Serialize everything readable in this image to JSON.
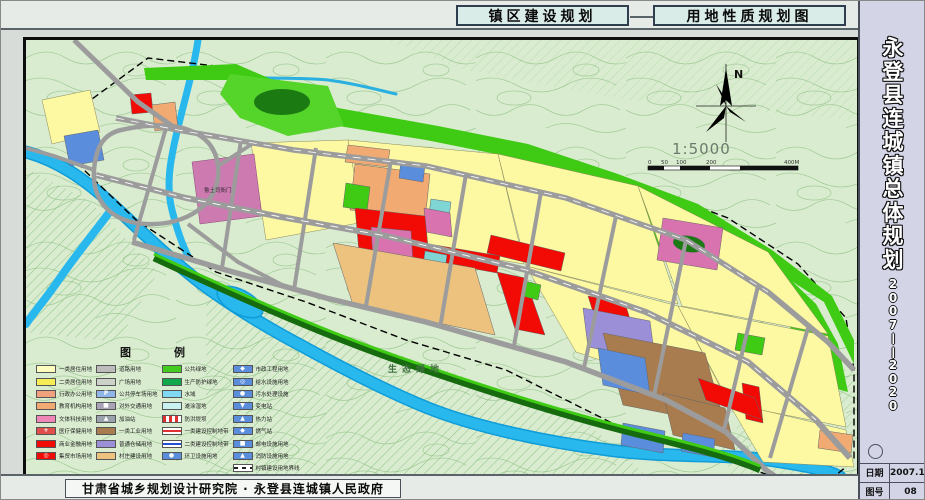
{
  "header": {
    "left_title": "镇区建设规划",
    "right_title": "用地性质规划图"
  },
  "sidebar": {
    "title": "永登县连城镇总体规划",
    "period": "2007——2020",
    "info_rows": [
      {
        "label": "日期",
        "value": "2007.11"
      },
      {
        "label": "图号",
        "value": "08"
      }
    ]
  },
  "footer": {
    "credit": "甘肃省城乡规划设计研究院 · 永登县连城镇人民政府"
  },
  "map": {
    "north_label": "N",
    "scale_text": "1:5000",
    "scale_ticks": [
      "0",
      "50",
      "100",
      "200",
      "400M"
    ],
    "eco_label": "生态绿地",
    "site_label": "鲁土司衙门"
  },
  "palette": {
    "map_bg": "#d9eccf",
    "contour": "#a6cd9c",
    "river": "#28b8ee",
    "green_belt": "#3fca14",
    "dark_green": "#1c7a12",
    "residential": "#fdf8a2",
    "commercial_red": "#f20a05",
    "culture_pink": "#d973b0",
    "education_orange": "#f0aa72",
    "industry_brown": "#a97c50",
    "warehouse_purple": "#9b8fd8",
    "municipal_blue": "#5b8ddd",
    "village_tan": "#ecc27e",
    "road": "#9c9c9c"
  },
  "legend": {
    "title": "图　例",
    "columns": [
      [
        {
          "t": "一类居住用地",
          "sw": "color",
          "c": "#fdfbbe"
        },
        {
          "t": "二类居住用地",
          "sw": "color",
          "c": "#f6ec55"
        },
        {
          "t": "行政办公用地",
          "sw": "color",
          "c": "#f2a17d"
        },
        {
          "t": "教育机构用地",
          "sw": "color",
          "c": "#f0aa72"
        },
        {
          "t": "文体科技用地",
          "sw": "color",
          "c": "#ee86b8"
        },
        {
          "t": "医疗保健用地",
          "sw": "color",
          "c": "#e14f4d",
          "s": "+",
          "scolor": "#ffffff"
        },
        {
          "t": "商业金融用地",
          "sw": "color",
          "c": "#f20a05"
        },
        {
          "t": "集贸市场用地",
          "sw": "color",
          "c": "#f20a05",
          "s": "◎",
          "scolor": "#ffffff"
        }
      ],
      [
        {
          "t": "道路用地",
          "sw": "color",
          "c": "#bcbcbc"
        },
        {
          "t": "广场用地",
          "sw": "color",
          "c": "#ccd2c8"
        },
        {
          "t": "公共停车场用地",
          "sw": "color",
          "c": "#8fb6e9",
          "s": "P",
          "scolor": "#ffffff"
        },
        {
          "t": "对外交通用地",
          "sw": "color",
          "c": "#a8a3b6",
          "s": "■",
          "scolor": "#ffffff"
        },
        {
          "t": "加油站",
          "sw": "color",
          "c": "#9aa2ac",
          "s": "▲",
          "scolor": "#ffffff"
        },
        {
          "t": "一类工业用地",
          "sw": "color",
          "c": "#a97c50"
        },
        {
          "t": "普通仓储用地",
          "sw": "color",
          "c": "#9b8fd8"
        },
        {
          "t": "村庄建设用地",
          "sw": "color",
          "c": "#ecc27e"
        }
      ],
      [
        {
          "t": "公共绿地",
          "sw": "color",
          "c": "#43cb20"
        },
        {
          "t": "生产防护绿地",
          "sw": "color",
          "c": "#11a84d"
        },
        {
          "t": "水域",
          "sw": "color",
          "c": "#7fd9f2"
        },
        {
          "t": "滩涂湿地",
          "sw": "color",
          "c": "#c9f1ef"
        },
        {
          "t": "防洪堤坝",
          "sw": "redhatch",
          "c": ""
        },
        {
          "t": "一类建设控制地带",
          "sw": "redbar",
          "c": ""
        },
        {
          "t": "二类建设控制地带",
          "sw": "bluebar",
          "c": ""
        },
        {
          "t": "环卫设施用地",
          "sw": "color",
          "c": "#5b8ddd",
          "s": "●",
          "scolor": "#ffffff"
        }
      ],
      [
        {
          "t": "市政工程用地",
          "sw": "color",
          "c": "#5b8ddd",
          "s": "◆",
          "scolor": "#ffffff"
        },
        {
          "t": "给水设施用地",
          "sw": "color",
          "c": "#5b8ddd",
          "s": "◎",
          "scolor": "#ffffff"
        },
        {
          "t": "污水处理设施",
          "sw": "color",
          "c": "#5b8ddd",
          "s": "●",
          "scolor": "#ffffff"
        },
        {
          "t": "变电站",
          "sw": "color",
          "c": "#5b8ddd",
          "s": "▼",
          "scolor": "#ffffff"
        },
        {
          "t": "热力站",
          "sw": "color",
          "c": "#5b8ddd",
          "s": "▲",
          "scolor": "#ffffff"
        },
        {
          "t": "燃气站",
          "sw": "color",
          "c": "#5b8ddd",
          "s": "◆",
          "scolor": "#ffffff"
        },
        {
          "t": "邮电设施用地",
          "sw": "color",
          "c": "#5b8ddd",
          "s": "■",
          "scolor": "#ffffff"
        },
        {
          "t": "消防设施用地",
          "sw": "color",
          "c": "#5b8ddd",
          "s": "▲",
          "scolor": "#ffffff"
        },
        {
          "t": "村镇建设用地界线",
          "sw": "dash",
          "c": ""
        }
      ]
    ]
  }
}
